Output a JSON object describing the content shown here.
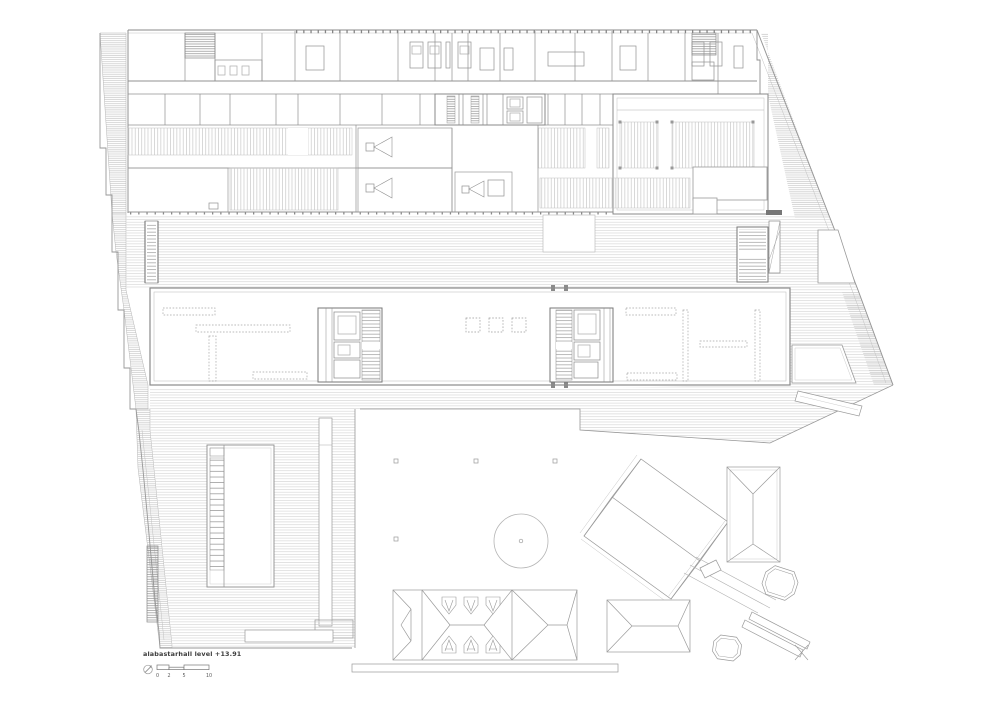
{
  "annotation": {
    "label": "alabastarhall level +13.91",
    "scale": {
      "ticks": [
        "0",
        "2",
        "5",
        "10"
      ]
    }
  },
  "colors": {
    "background": "#ffffff",
    "linework": "#8f8f8f",
    "linework_light": "#c4c4c4",
    "wall_accent": "#6f6f6f",
    "hatch": "#d6d6d6",
    "label_text": "#3c3c3c"
  }
}
